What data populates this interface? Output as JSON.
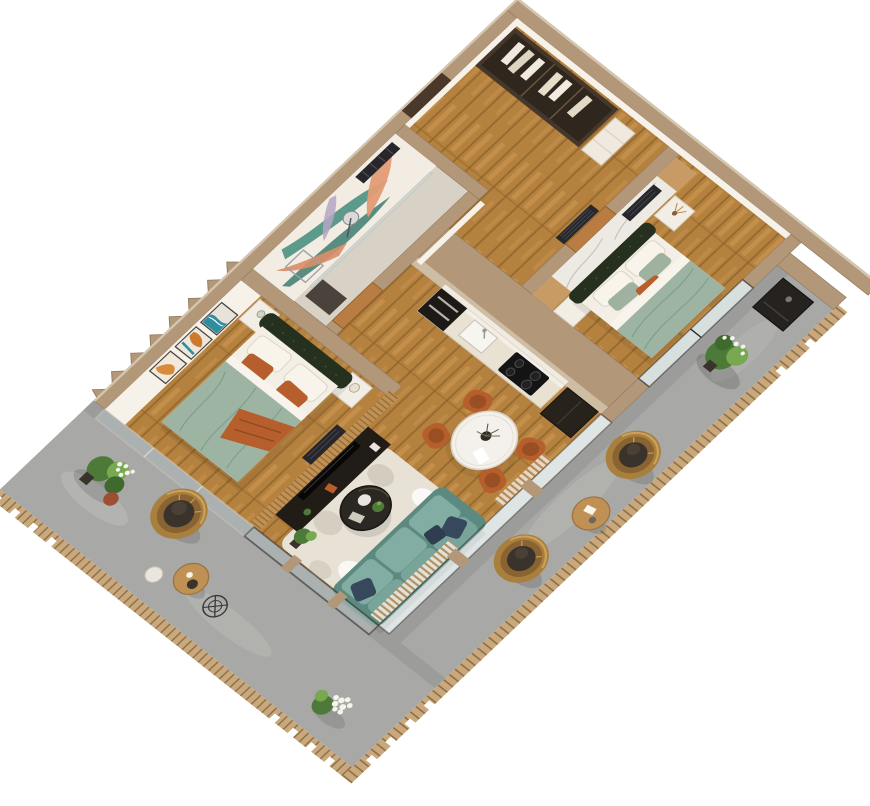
{
  "scene": {
    "title": "3D isometric cutaway render of a two-bedroom apartment with wrap-around balcony",
    "view": "top-down isometric, rotated diamond orientation",
    "background": "#ffffff"
  },
  "palette": {
    "wall": "#b29878",
    "wall_light": "#d4c5ae",
    "wall_dark": "#93785d",
    "wood_floor": "#b5813f",
    "wood_floor_light": "#cd9b55",
    "wood_floor_dark": "#8a6128",
    "tile_floor": "#d7d1c6",
    "balcony_floor": "#a8a8a6",
    "balcony_floor_light": "#bdbdbb",
    "rail_wood": "#c9a87c",
    "rail_wood_dark": "#8a6b45",
    "interior_white": "#f6f1e9",
    "marble": "#edeae4",
    "marble_vein": "#c6c0b8",
    "wood_trim": "#c79b63",
    "slat_wood": "#c09155",
    "slat_line": "#8f6330",
    "door_wood": "#b97c42",
    "door_dark": "#4a382a",
    "radiator": "#26262b",
    "bed_green": "#25301f",
    "duvet": "#9db4a3",
    "duvet_dark": "#7b978a",
    "sheet_white": "#f3efe6",
    "orange": "#b65f2c",
    "orange_dark": "#8f4a20",
    "sofa": "#78a49a",
    "sofa_dark": "#5d8a80",
    "sofa_seat": "#82ada2",
    "navy": "#37485c",
    "rug": "#e7e1d6",
    "rug_blob": "#cbc4b6",
    "dark_furniture": "#221c16",
    "appliance_black": "#141414",
    "cream_cabinet": "#e9e1d2",
    "rattan": "#a97f3e",
    "rattan_dark": "#8a6332",
    "rattan_light": "#d2a860",
    "cushion": "#3a332b",
    "plant": "#4d7a38",
    "plant_light": "#78a850",
    "plant_red": "#9c4f33",
    "flower_white": "#f4f4ec",
    "table_white": "#f4f1ec",
    "glass": "#b9c7c6",
    "frame_dark": "#26241f",
    "curtain_a": "#b98e5e",
    "curtain_b": "#efe9df",
    "mural_bg": "#f3ece2",
    "mural_teal": "#4b9183",
    "mural_teal_dark": "#3d7d70",
    "mural_peach": "#e39c74",
    "mural_peach_dark": "#d98e66",
    "mural_lilac": "#b5a6c4",
    "art_teal": "#2f8da0",
    "art_orange": "#cd7a2e"
  },
  "rooms": {
    "entry_hall": {
      "label": "Entry hall with open wardrobe and hanging clothes"
    },
    "mural_room": {
      "label": "Bathroom with tropical leaf wall mural, towel radiator and floor lamp"
    },
    "bedroom_1": {
      "label": "Bedroom with dark green tufted bed, sage duvet, orange pillows and three framed artworks"
    },
    "bedroom_2": {
      "label": "Bedroom with marble accent wall, dark green bed and sage duvet"
    },
    "kitchen": {
      "label": "Kitchen run with cream cabinets, black oven tower, cooktop and sink"
    },
    "dining": {
      "label": "Dining corner with round white table and burnt-orange chairs"
    },
    "living_room": {
      "label": "Living room with teal sofa, black coffee table, rug, TV console and slat media wall"
    },
    "balcony": {
      "label": "Wrap-around balcony with rattan hanging egg chairs, side tables and plants"
    }
  },
  "furniture": {
    "entry_hall": [
      "open wardrobe with hanging clothes",
      "entry door",
      "shelf unit",
      "radiator"
    ],
    "mural_room": [
      "tropical leaf mural",
      "black towel radiator",
      "floor lamp",
      "glass partition",
      "dark vanity"
    ],
    "bedroom_1": [
      "double bed",
      "two white nightstands",
      "three framed abstract artworks",
      "radiator",
      "orange throw"
    ],
    "bedroom_2": [
      "double bed",
      "marble accent wall with wood trim",
      "two white nightstands",
      "dried flowers",
      "radiator",
      "window"
    ],
    "kitchen": [
      "cream cabinet run",
      "black oven tower",
      "cooktop",
      "sink",
      "tall dark unit"
    ],
    "dining": [
      "round white pedestal table",
      "four burnt-orange chairs",
      "centerpiece"
    ],
    "living_room": [
      "teal three-seat sofa",
      "navy cushions",
      "round black coffee table",
      "patterned cream rug",
      "dark TV console",
      "TV",
      "wood slat media wall",
      "striped curtains",
      "floor plant"
    ],
    "balcony": [
      "three rattan hanging egg chairs",
      "two round wood side tables",
      "white stool",
      "wire stool",
      "plant cluster with white flowers",
      "white flower bouquet",
      "potted plant",
      "wall-mounted dark cabinet",
      "slatted wood railing",
      "sawtooth cut wall"
    ]
  }
}
